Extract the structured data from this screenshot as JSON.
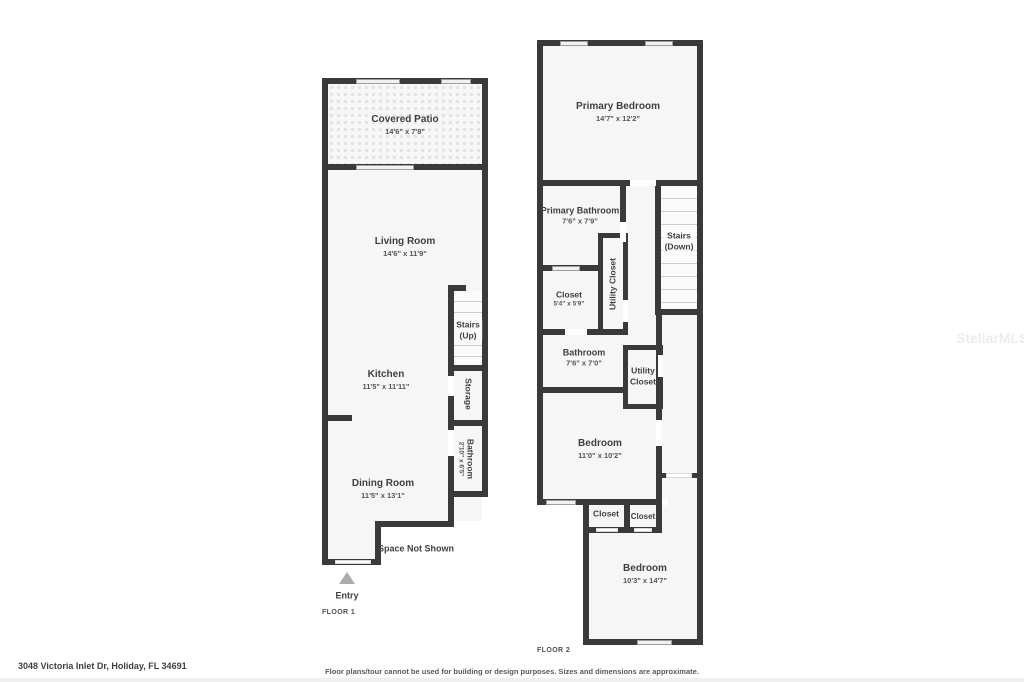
{
  "watermark": "StellarMLS",
  "colors": {
    "wall": "#3a3a3a",
    "room_fill": "#f6f6f6",
    "background": "#ffffff"
  },
  "floor1": {
    "label": "FLOOR 1",
    "covered_patio_name": "Covered Patio",
    "covered_patio_dims": "14'6\" x 7'8\"",
    "living_room_name": "Living Room",
    "living_room_dims": "14'6\" x 11'9\"",
    "kitchen_name": "Kitchen",
    "kitchen_dims": "11'5\" x 11'11\"",
    "dining_room_name": "Dining Room",
    "dining_room_dims": "11'5\" x 13'1\"",
    "stairs_line1": "Stairs",
    "stairs_line2": "(Up)",
    "storage_name": "Storage",
    "bathroom_name": "Bathroom",
    "bathroom_dims": "2'10\" x 6'5\"",
    "space_not_shown": "Space Not Shown",
    "entry_label": "Entry"
  },
  "floor2": {
    "label": "FLOOR 2",
    "primary_bedroom_name": "Primary Bedroom",
    "primary_bedroom_dims": "14'7\" x 12'2\"",
    "primary_bathroom_name": "Primary Bathroom",
    "primary_bathroom_dims": "7'6\" x 7'9\"",
    "utility_closet_upper_name": "Utility Closet",
    "stairs_line1": "Stairs",
    "stairs_line2": "(Down)",
    "closet_upper_name": "Closet",
    "closet_upper_dims": "5'4\" x 5'9\"",
    "bathroom_name": "Bathroom",
    "bathroom_dims": "7'6\" x 7'0\"",
    "utility_closet_lower_line1": "Utility",
    "utility_closet_lower_line2": "Closet",
    "bedroom_middle_name": "Bedroom",
    "bedroom_middle_dims": "11'0\" x 10'2\"",
    "closet_left_name": "Closet",
    "closet_right_name": "Closet",
    "bedroom_bottom_name": "Bedroom",
    "bedroom_bottom_dims": "10'3\" x 14'7\""
  },
  "footer": {
    "address": "3048 Victoria Inlet Dr, Holiday, FL 34691",
    "disclaimer": "Floor plans/tour cannot be used for building or design purposes. Sizes and dimensions are approximate."
  }
}
